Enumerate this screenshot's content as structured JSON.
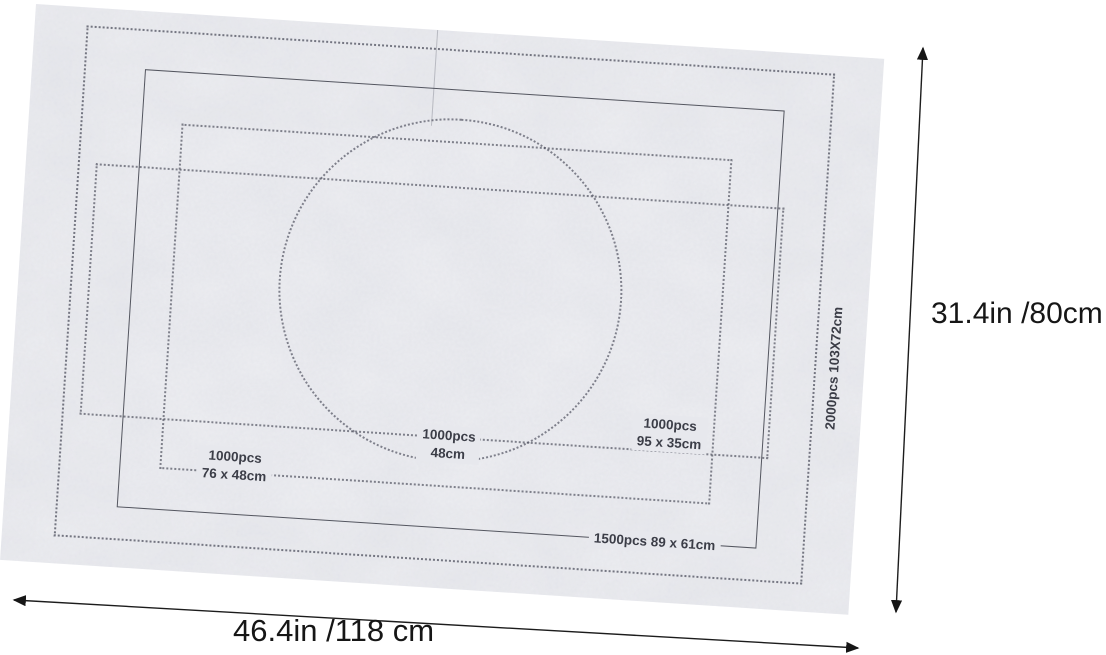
{
  "mat": {
    "description": "gray felt puzzle roll-up mat with printed size outlines",
    "felt_color": "#e7e8ed",
    "print_color": "#3b3d47",
    "zones": {
      "round": {
        "line1": "1000pcs",
        "line2": "48cm"
      },
      "rect76": {
        "line1": "1000pcs",
        "line2": "76 x 48cm"
      },
      "wide95": {
        "line1": "1000pcs",
        "line2": "95 x 35cm"
      },
      "solid1500": {
        "label": "1500pcs 89  x 61cm"
      },
      "outer2000": {
        "label": "2000pcs 103X72cm"
      }
    }
  },
  "dimensions": {
    "annotation_color": "#161616",
    "height_label": "31.4in /80cm",
    "width_label": "46.4in /118 cm"
  }
}
